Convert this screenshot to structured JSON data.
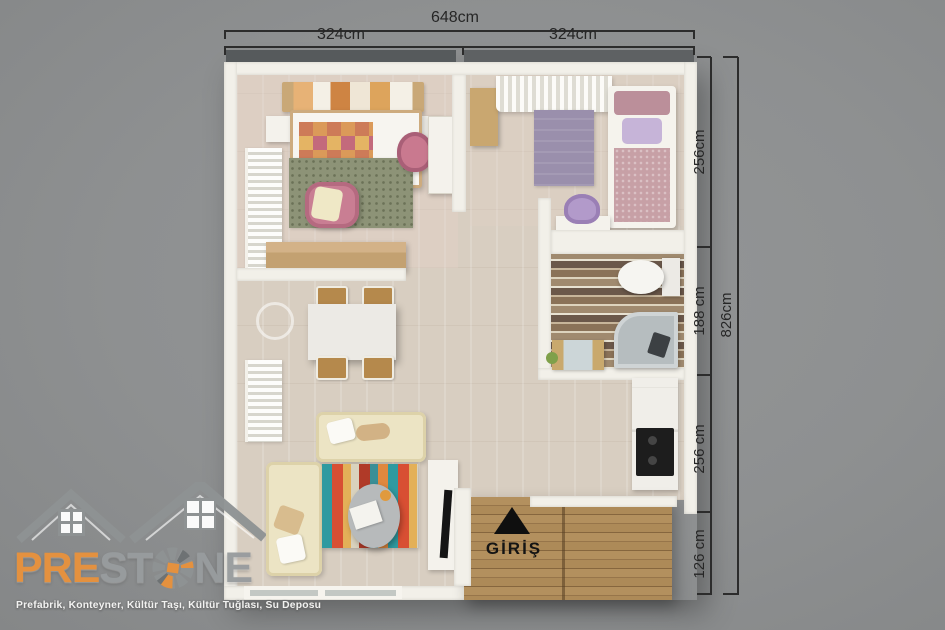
{
  "dimensions": {
    "top_total": "648cm",
    "top_left": "324cm",
    "top_right": "324cm",
    "right_total": "826cm",
    "right_segments": [
      "256cm",
      "188 cm",
      "256 cm",
      "126 cm"
    ]
  },
  "entrance": {
    "label": "GİRİŞ",
    "arrow_icon": "triangle-up"
  },
  "logo": {
    "brand_pre": "PRE",
    "brand_st": "ST",
    "brand_ne": "NE",
    "stone_o_icon": "stone-circle",
    "houses_icon": "twin-house-roofs",
    "tagline": "Prefabrik, Konteyner, Kültür Taşı, Kültür Tuğlası, Su Deposu",
    "colors": {
      "orange": "#e8923c",
      "gray": "#989c9e"
    }
  },
  "colors": {
    "background": "#8e9091",
    "wall": "#f2f0e9",
    "floor": "#d8cec1",
    "deck_wood": "#ad8a58",
    "dimension_lines": "#2c2c2c"
  }
}
